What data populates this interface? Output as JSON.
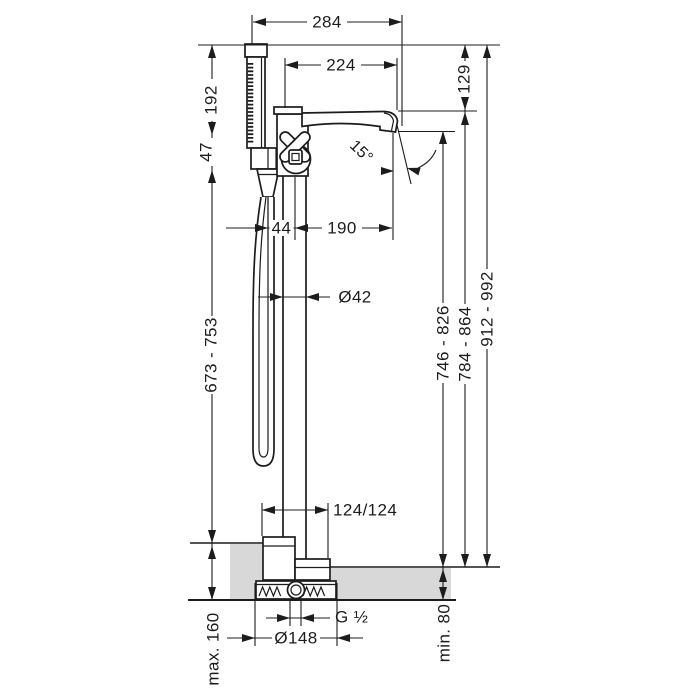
{
  "colors": {
    "line": "#1c1c1c",
    "floor_fill": "#d8d8d8",
    "background": "#ffffff"
  },
  "dimensions": {
    "overall_width": "284",
    "spout_width_top": "224",
    "spout_height_drop": "129",
    "handshower_height": "192",
    "holder_drop": "47",
    "spray_angle": "15°",
    "hose_axis_offset": "44",
    "spout_reach": "190",
    "riser_diameter": "Ø42",
    "handshower_hose_height": "673 - 753",
    "outlet_height": "746 - 826",
    "spout_top_height": "784 - 864",
    "overall_height": "912 - 992",
    "base_offsets": "124/124",
    "thread_size": "G ½",
    "base_plate_diameter": "Ø148",
    "floor_buildup_max": "max. 160",
    "floor_buildup_min": "min. 80"
  }
}
